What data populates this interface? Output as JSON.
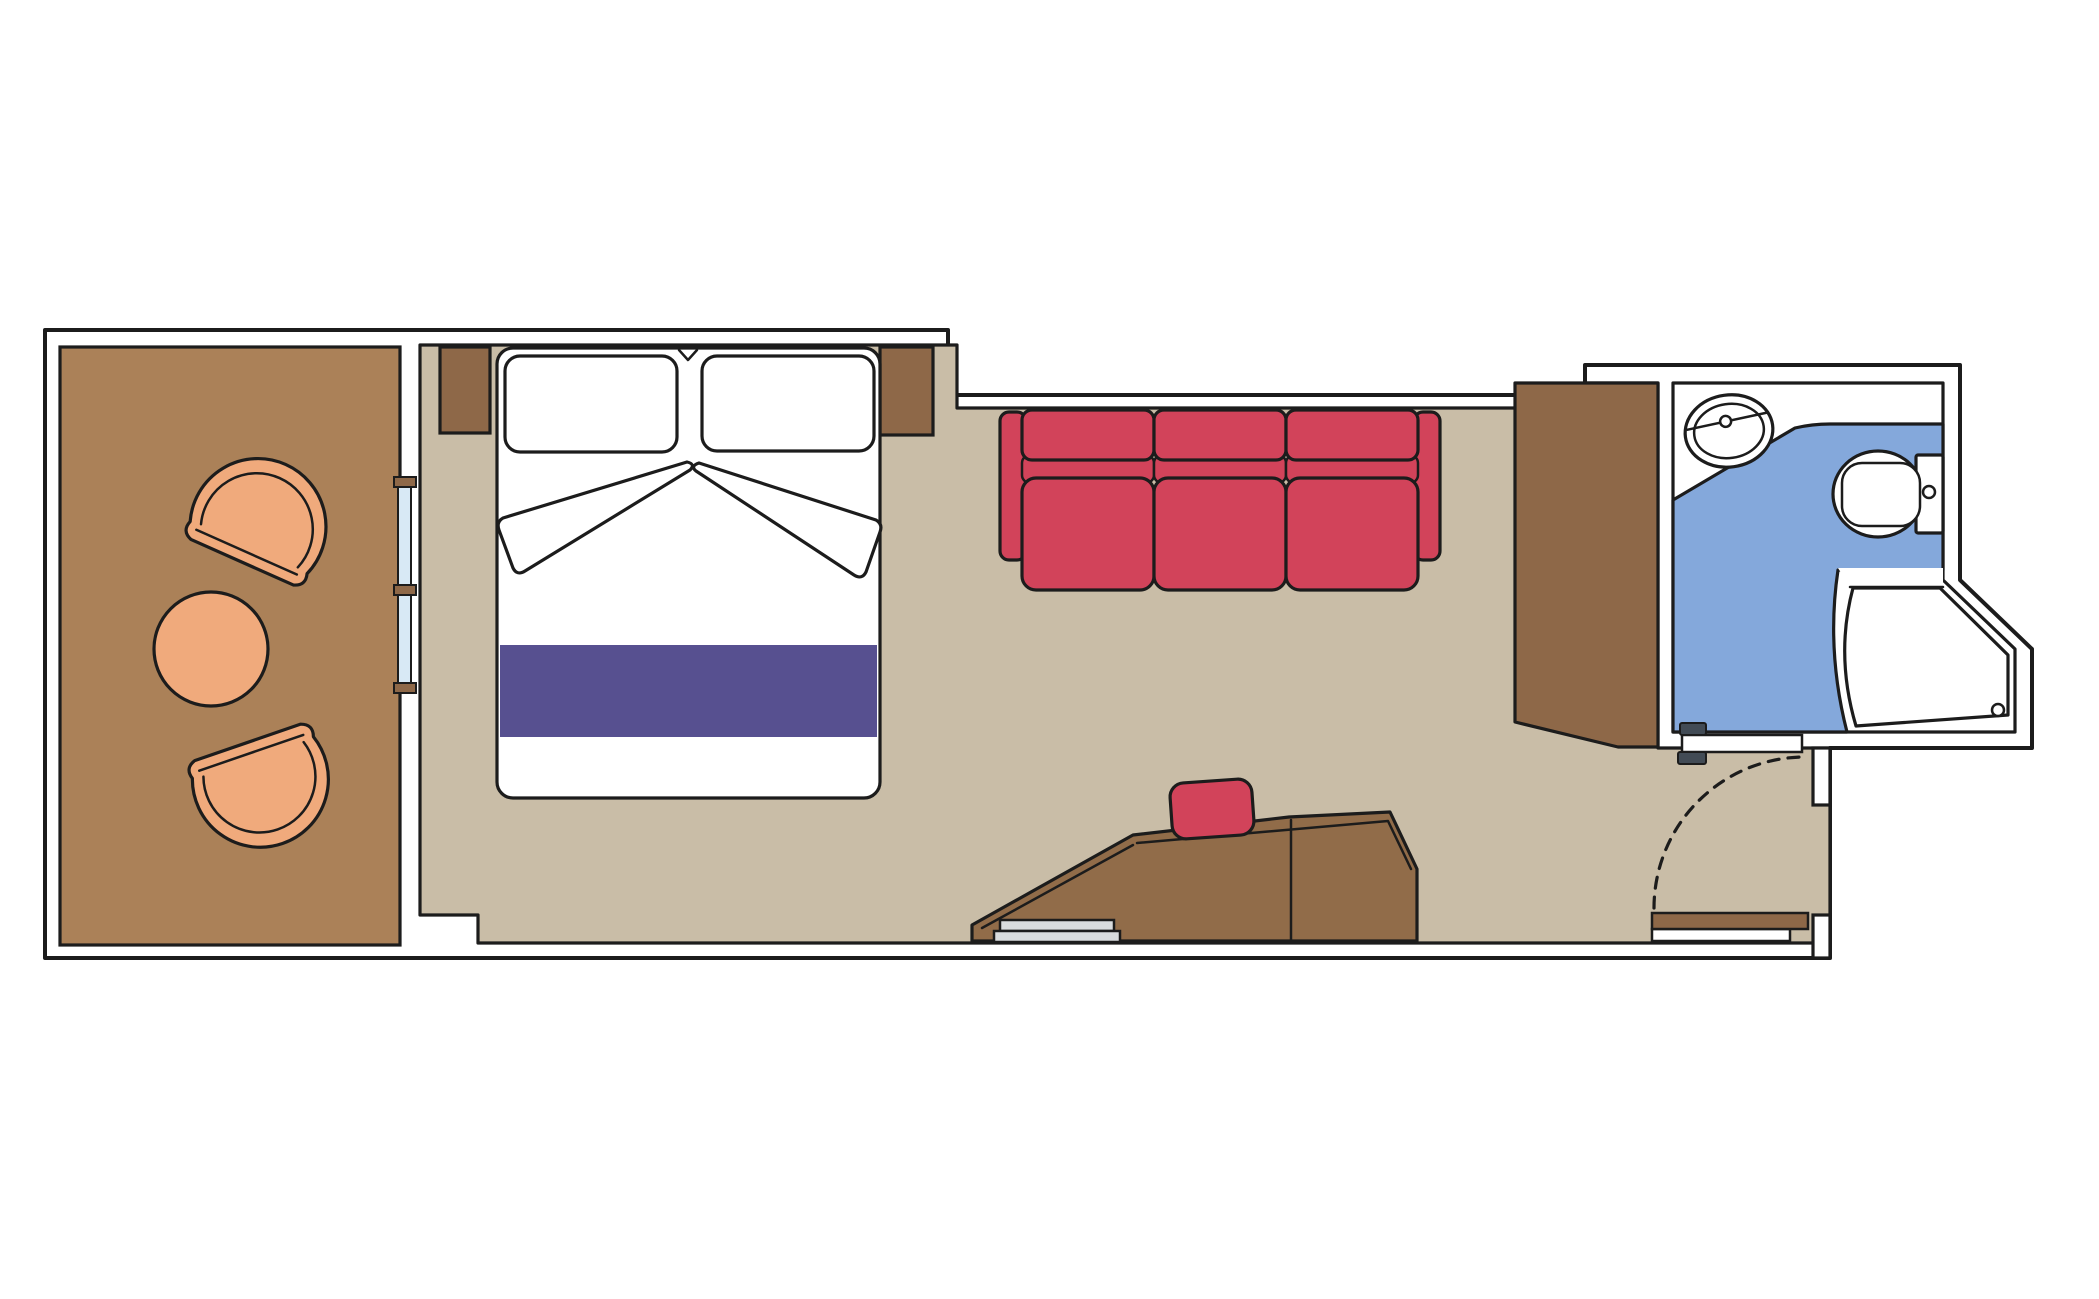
{
  "diagram": {
    "type": "floor-plan",
    "subject": "cruise-ship balcony stateroom plan view",
    "rooms": [
      {
        "name": "balcony",
        "floor": "wood",
        "furniture": [
          "tub-chair",
          "round-table",
          "tub-chair"
        ],
        "access": "sliding-glass-door"
      },
      {
        "name": "cabin",
        "floor": "carpet",
        "furniture": [
          "double-bed",
          "two-pillows",
          "two-nightstands",
          "three-seat-sofa",
          "wardrobe",
          "desk-dresser",
          "stool"
        ]
      },
      {
        "name": "bathroom",
        "floor": "tile",
        "furniture": [
          "washbasin",
          "toilet",
          "corner-shower"
        ],
        "access": "sliding-door"
      },
      {
        "name": "entry",
        "access": "hinged-entry-door-with-swing-arc"
      }
    ]
  },
  "colors": {
    "line": "#1c1c1c",
    "wall_fill": "#ffffff",
    "balcony_floor": "#ab8158",
    "room_floor": "#c9bda7",
    "furniture_wood": "#8e6848",
    "desk_wood": "#916c49",
    "chair_orange": "#f0aa7c",
    "sofa_red": "#d2435a",
    "bed_runner_purple": "#575090",
    "bathroom_floor_blue": "#84a8db",
    "glass_blue": "#d8e9f5",
    "handle_dark": "#424b55",
    "tray_gray": "#d9dcde",
    "white": "#ffffff"
  }
}
